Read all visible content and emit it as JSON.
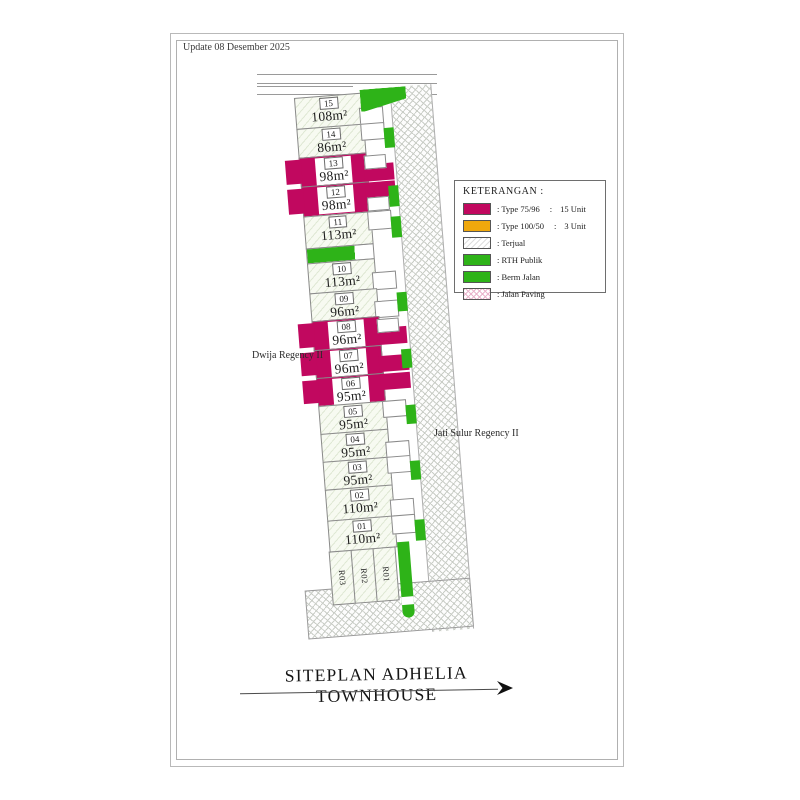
{
  "update_label": "Update 08 Desember 2025",
  "title": "SITEPLAN ADHELIA TOWNHOUSE",
  "area_labels": {
    "left": "Dwija Regency II",
    "right": "Jati Sulur Regency II"
  },
  "legend": {
    "title": "KETERANGAN  :",
    "items": [
      {
        "swatch": "magenta",
        "label": ": Type 75/96",
        "sep": ":",
        "value": "15 Unit"
      },
      {
        "swatch": "orange",
        "label": ": Type 100/50",
        "sep": ":",
        "value": "3 Unit"
      },
      {
        "swatch": "hatch",
        "label": ": Terjual"
      },
      {
        "swatch": "green",
        "label": ": RTH Publik"
      },
      {
        "swatch": "green",
        "label": ": Berm Jalan"
      },
      {
        "swatch": "paving",
        "label": ": Jalan Paving"
      }
    ]
  },
  "lots": [
    {
      "no": "15",
      "area": "108m²",
      "status": "sold"
    },
    {
      "no": "14",
      "area": "86m²",
      "status": "sold"
    },
    {
      "no": "13",
      "area": "98m²",
      "status": "available"
    },
    {
      "no": "12",
      "area": "98m²",
      "status": "available"
    },
    {
      "no": "11",
      "area": "113m²",
      "status": "sold"
    },
    {
      "no": "10",
      "area": "113m²",
      "status": "sold"
    },
    {
      "no": "09",
      "area": "96m²",
      "status": "sold"
    },
    {
      "no": "08",
      "area": "96m²",
      "status": "available"
    },
    {
      "no": "07",
      "area": "96m²",
      "status": "available"
    },
    {
      "no": "06",
      "area": "95m²",
      "status": "available"
    },
    {
      "no": "05",
      "area": "95m²",
      "status": "sold"
    },
    {
      "no": "04",
      "area": "95m²",
      "status": "sold"
    },
    {
      "no": "03",
      "area": "95m²",
      "status": "sold"
    },
    {
      "no": "02",
      "area": "110m²",
      "status": "sold"
    },
    {
      "no": "01",
      "area": "110m²",
      "status": "sold"
    }
  ],
  "r_lots": [
    "R03",
    "R02",
    "R01"
  ],
  "colors": {
    "magenta": "#c1085f",
    "orange": "#efa80d",
    "green": "#2eb318",
    "line": "#8a8a8a",
    "hatchline": "#dfe8d4",
    "paving_gray": "#c9cdc6",
    "paving_pink": "#eab4cc"
  }
}
